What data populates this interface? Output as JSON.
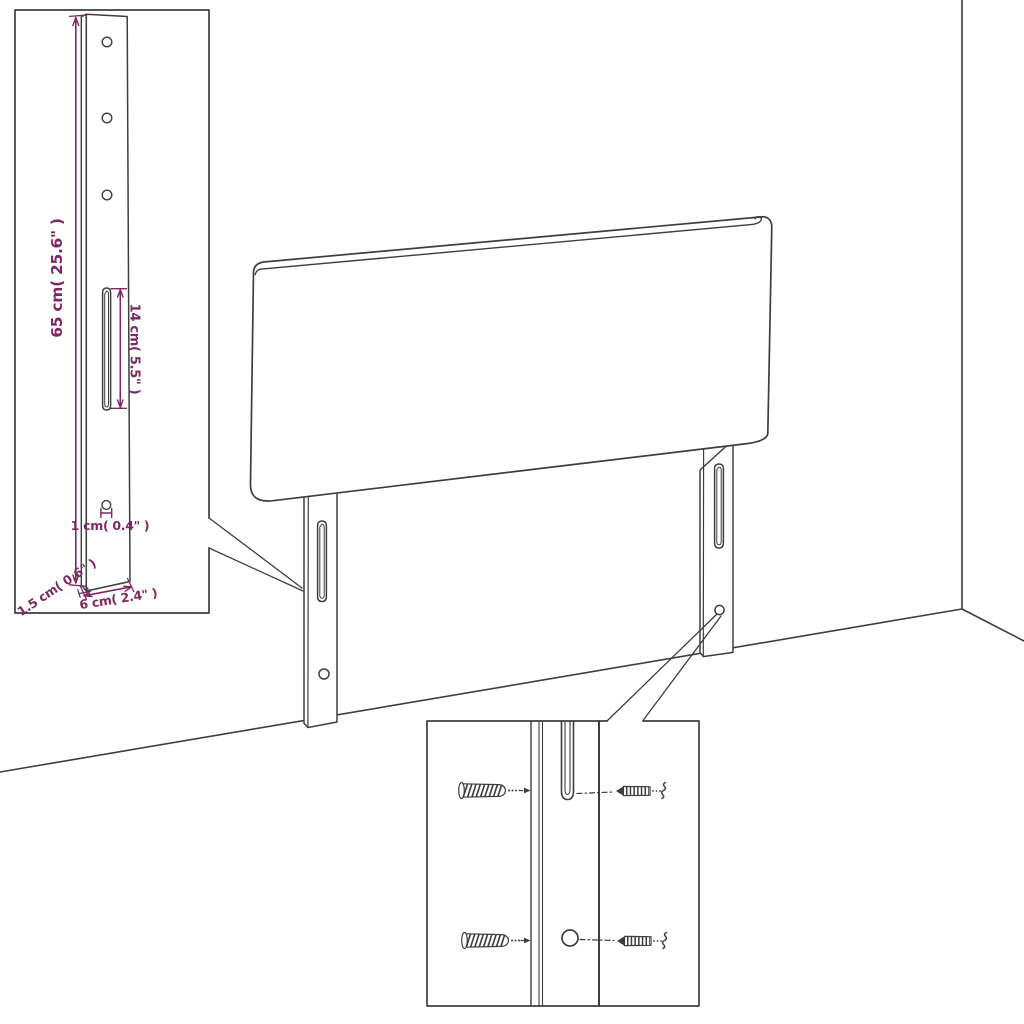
{
  "figure": {
    "title": "Headboard wall-mounting dimension diagram",
    "product": "headboard-with-wall-brackets"
  },
  "colors": {
    "background": "#ffffff",
    "line": "#3e3e3e",
    "dimension_accent": "#7d2963"
  },
  "bracket_inset": {
    "height_label": "65 cm( 25.6\" )",
    "slot_label": "14 cm( 5.5\" )",
    "hole_label": "1 cm( 0.4\" )",
    "depth_label": "1.5 cm( 0.6\" )",
    "width_label": "6 cm( 2.4\" )"
  },
  "hardware_inset": {
    "icons": [
      "wall-plug-icon",
      "screw-icon",
      "mounting-slot",
      "mounting-hole"
    ]
  }
}
